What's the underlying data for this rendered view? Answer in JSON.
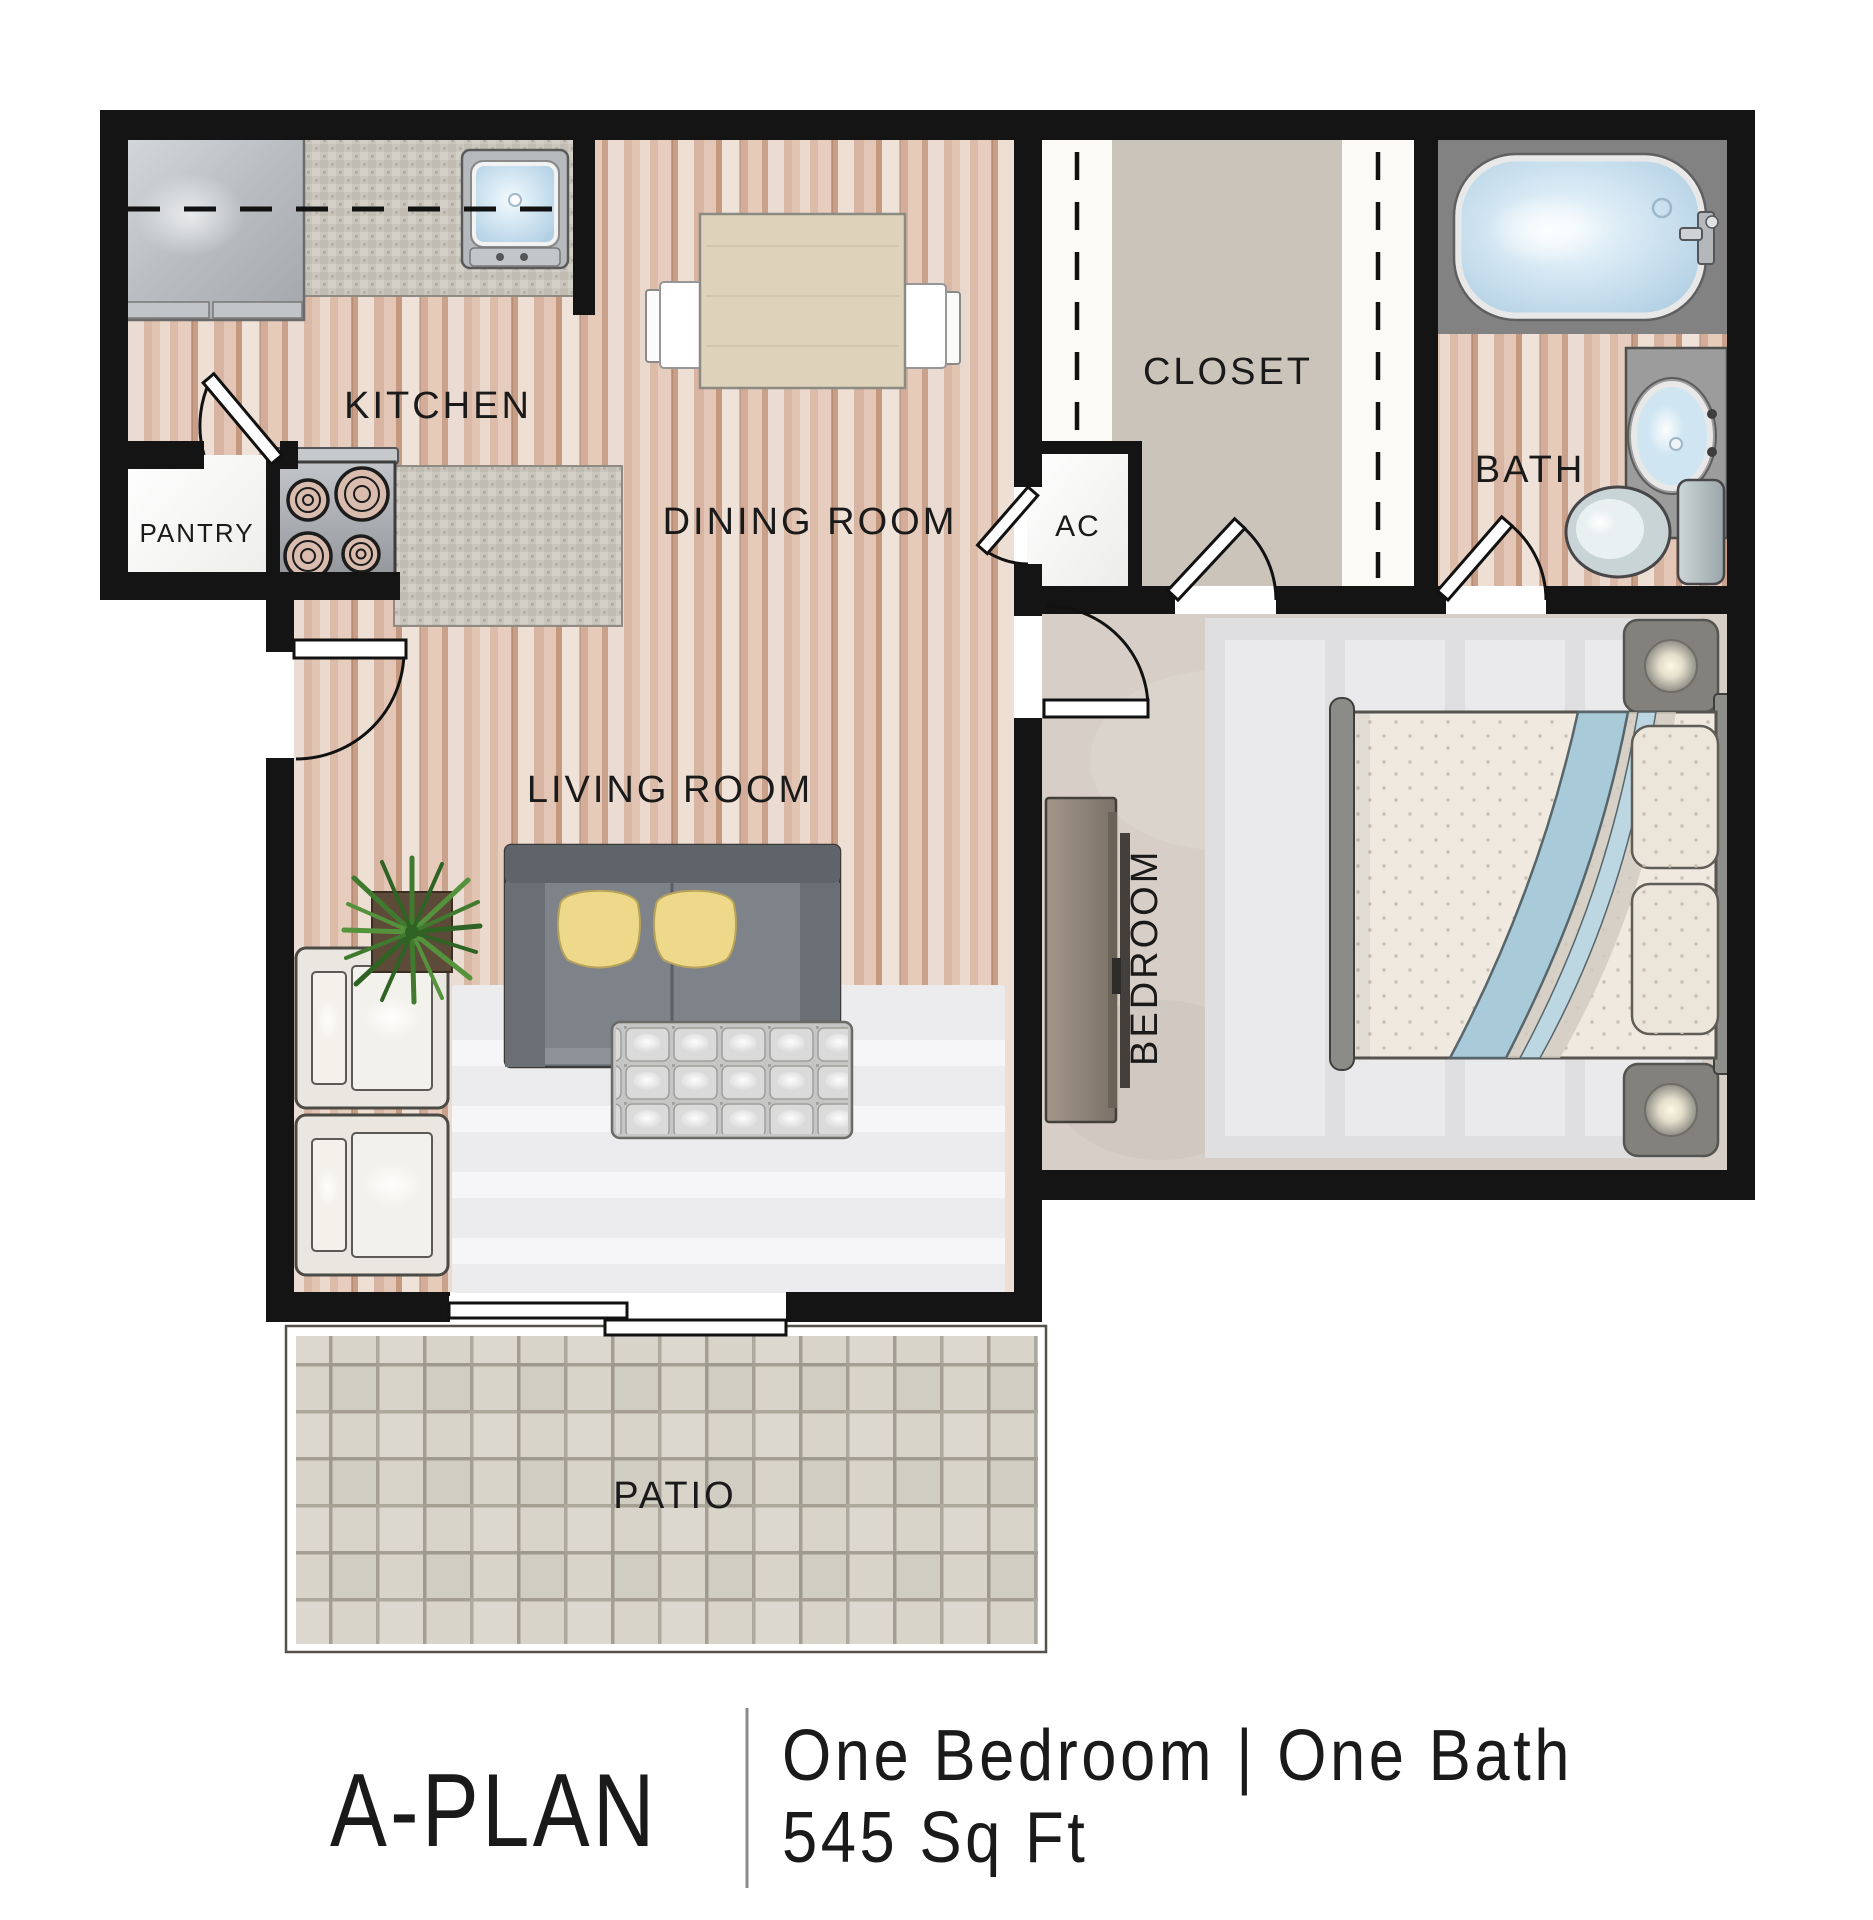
{
  "rooms": {
    "kitchen": "KITCHEN",
    "pantry": "PANTRY",
    "dining": "DINING ROOM",
    "closet": "CLOSET",
    "ac": "AC",
    "bath": "BATH",
    "living": "LIVING ROOM",
    "bedroom": "BEDROOM",
    "patio": "PATIO"
  },
  "caption": {
    "plan": "A-PLAN",
    "type": "One Bedroom | One Bath",
    "area": "545 Sq Ft"
  },
  "colors": {
    "wall": "#141414",
    "wood_floor": "#e6cdbd",
    "closet_floor": "#cbc4bb",
    "bedroom_carpet": "#d7cfc7",
    "patio_tile": "#d8d4c9",
    "water_blue": "#bdd9ec",
    "pillow_yellow": "#eed98b",
    "label_text": "#1a1a1a"
  },
  "fixtures": [
    "refrigerator",
    "kitchen-sink",
    "upper-cabinet-dashed-line",
    "stove-burners",
    "granite-counter",
    "pantry-door",
    "entry-door",
    "dining-table",
    "dining-chair",
    "sofa",
    "throw-pillow",
    "area-rug",
    "ottoman",
    "armchair",
    "potted-plant",
    "sliding-glass-door",
    "patio-tiles",
    "closet-rod-dashed-line",
    "closet-door",
    "ac-closet",
    "ac-door",
    "bathtub",
    "vanity-sink",
    "toilet",
    "bath-door",
    "bedroom-door",
    "bed",
    "bed-pillow",
    "bed-ribbon",
    "nightstand-lamp",
    "dresser-tv",
    "bedroom-rug"
  ]
}
